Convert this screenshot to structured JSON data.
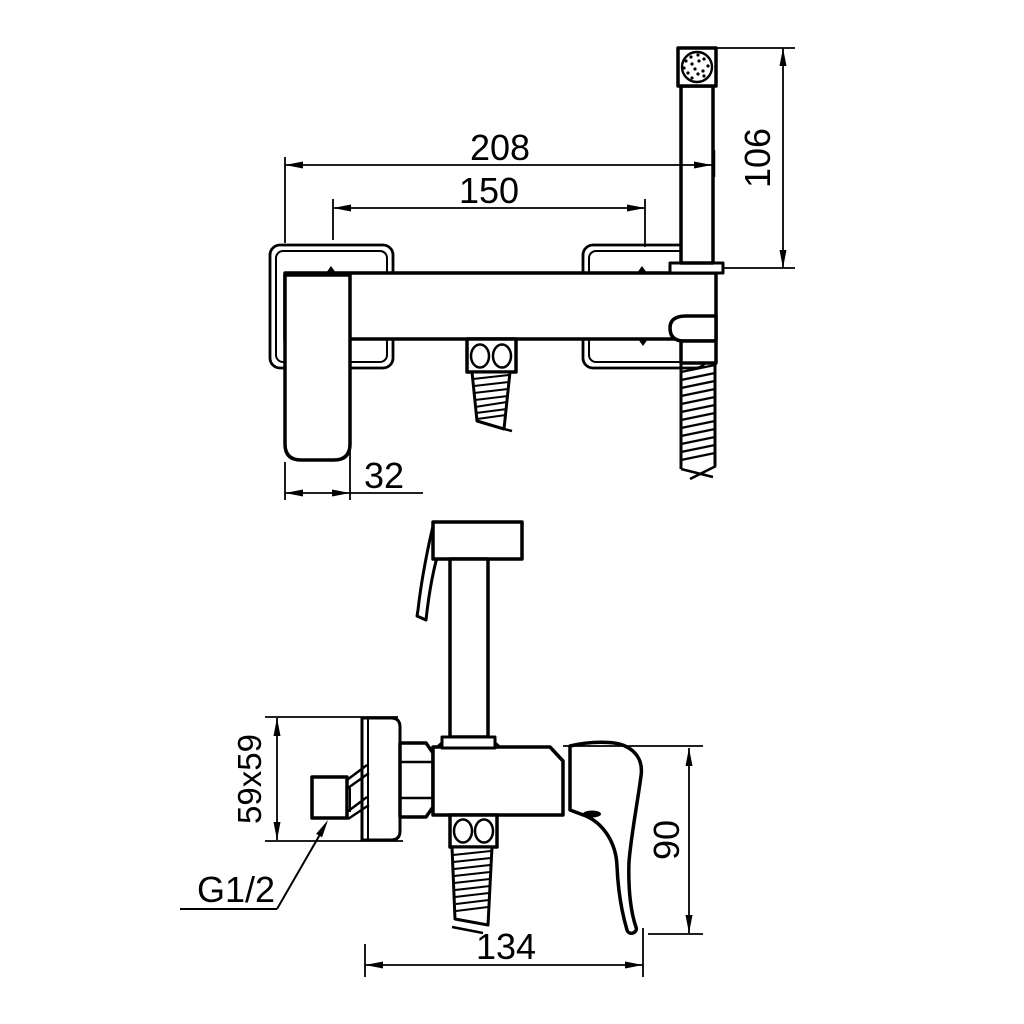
{
  "drawing": {
    "background": "#ffffff",
    "line_color": "#000000"
  },
  "dims": {
    "overall_width": "208",
    "hose_centers": "150",
    "handshower_height": "106",
    "handle_projection": "32",
    "escutcheon_size": "59x59",
    "thread_size": "G1/2",
    "body_height": "90",
    "body_depth": "134"
  }
}
